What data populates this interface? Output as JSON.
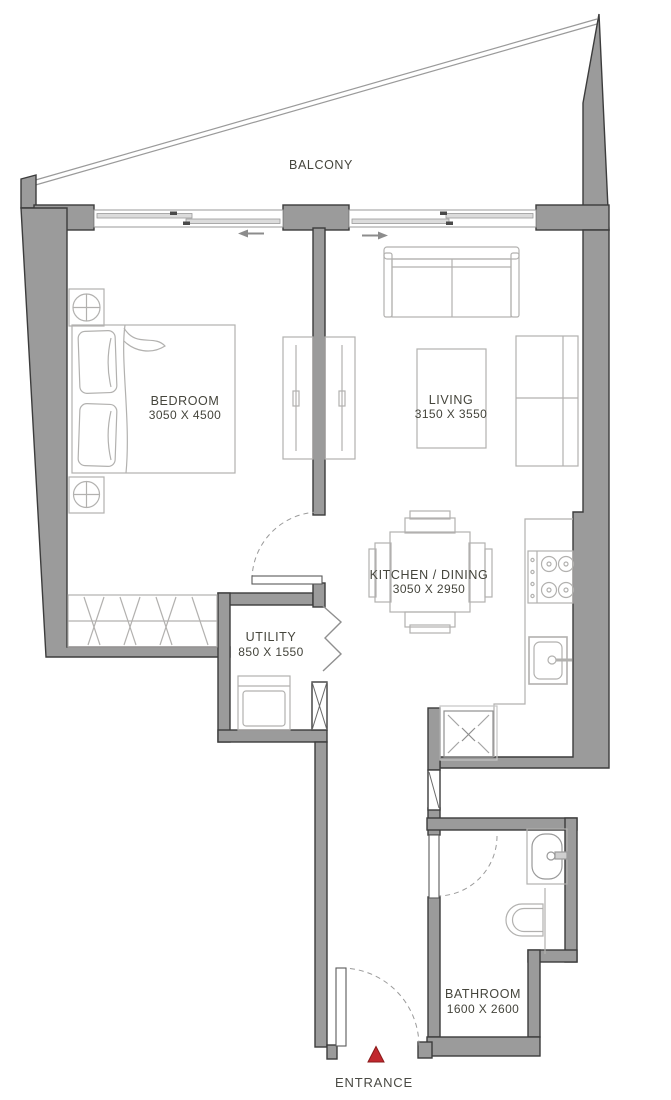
{
  "plan": {
    "balcony": {
      "label": "BALCONY"
    },
    "bedroom": {
      "label": "BEDROOM",
      "dims": "3050 X 4500"
    },
    "living": {
      "label": "LIVING",
      "dims": "3150 X 3550"
    },
    "kitchen": {
      "label": "KITCHEN / DINING",
      "dims": "3050 X 2950"
    },
    "utility": {
      "label": "UTILITY",
      "dims": "850 X 1550"
    },
    "bathroom": {
      "label": "BATHROOM",
      "dims": "1600 X 2600"
    },
    "entrance": {
      "label": "ENTRANCE"
    },
    "colors": {
      "wall_fill": "#9b9b9b",
      "wall_outline": "#3c3c3c",
      "furniture_line": "#b2b1af",
      "label_text": "#45453c",
      "entrance_marker": "#c1272d"
    }
  }
}
